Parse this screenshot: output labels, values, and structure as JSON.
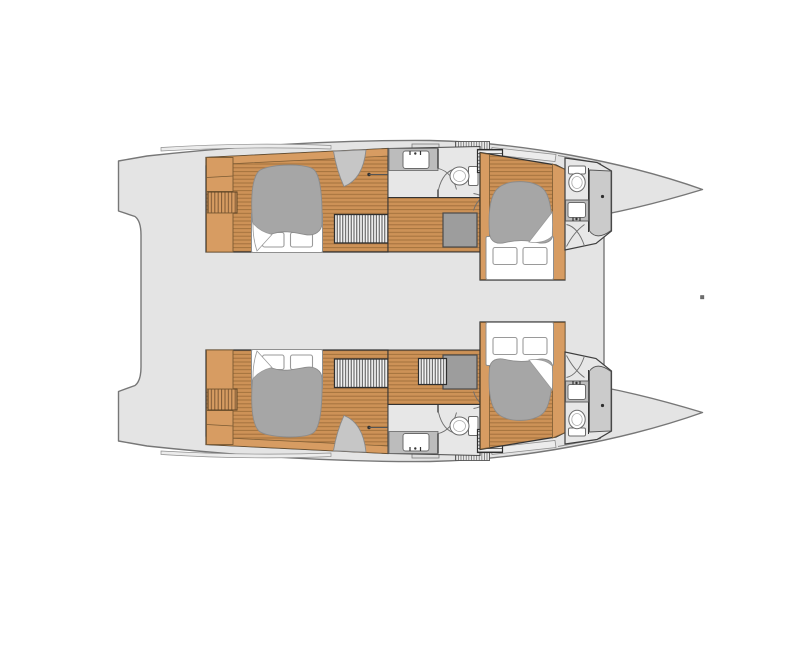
{
  "figure": {
    "kind": "catamaran-deck-plan-top-view",
    "hulls": [
      {
        "name": "port-hull",
        "cabins": 2,
        "heads": 2,
        "double_beds": 2,
        "toilets": 2,
        "sinks": 2,
        "showers": 2
      },
      {
        "name": "starboard-hull",
        "cabins": 2,
        "heads": 2,
        "double_beds": 2,
        "toilets": 2,
        "sinks": 2,
        "showers": 2
      }
    ],
    "totals": {
      "cabins": 4,
      "double_beds": 4,
      "heads": 4,
      "toilets": 4,
      "sinks": 4,
      "showers": 4
    }
  },
  "colors": {
    "background": "#ffffff",
    "hullFill": "#e4e4e4",
    "hullStroke": "#777777",
    "deckStrip": "#ececec",
    "wood": "#d79c62",
    "woodDark": "#7a5a33",
    "floorBase": "#cd9257",
    "floorStripe": "#a3713d",
    "wall": "#333333",
    "bathFloor": "#e7e7e7",
    "counter": "#bcbcbc",
    "showerLight": "#cbcbcb",
    "showerDark": "#9d9d9d",
    "duvet": "#a6a6a6",
    "duvetStroke": "#8c8c8c",
    "fixtureFill": "#ffffff",
    "fixtureStroke": "#6b6b6b",
    "louverBg": "#f4f4f4",
    "louverLine": "#3e3e3e",
    "fittingDot": "#6e6e6e"
  }
}
